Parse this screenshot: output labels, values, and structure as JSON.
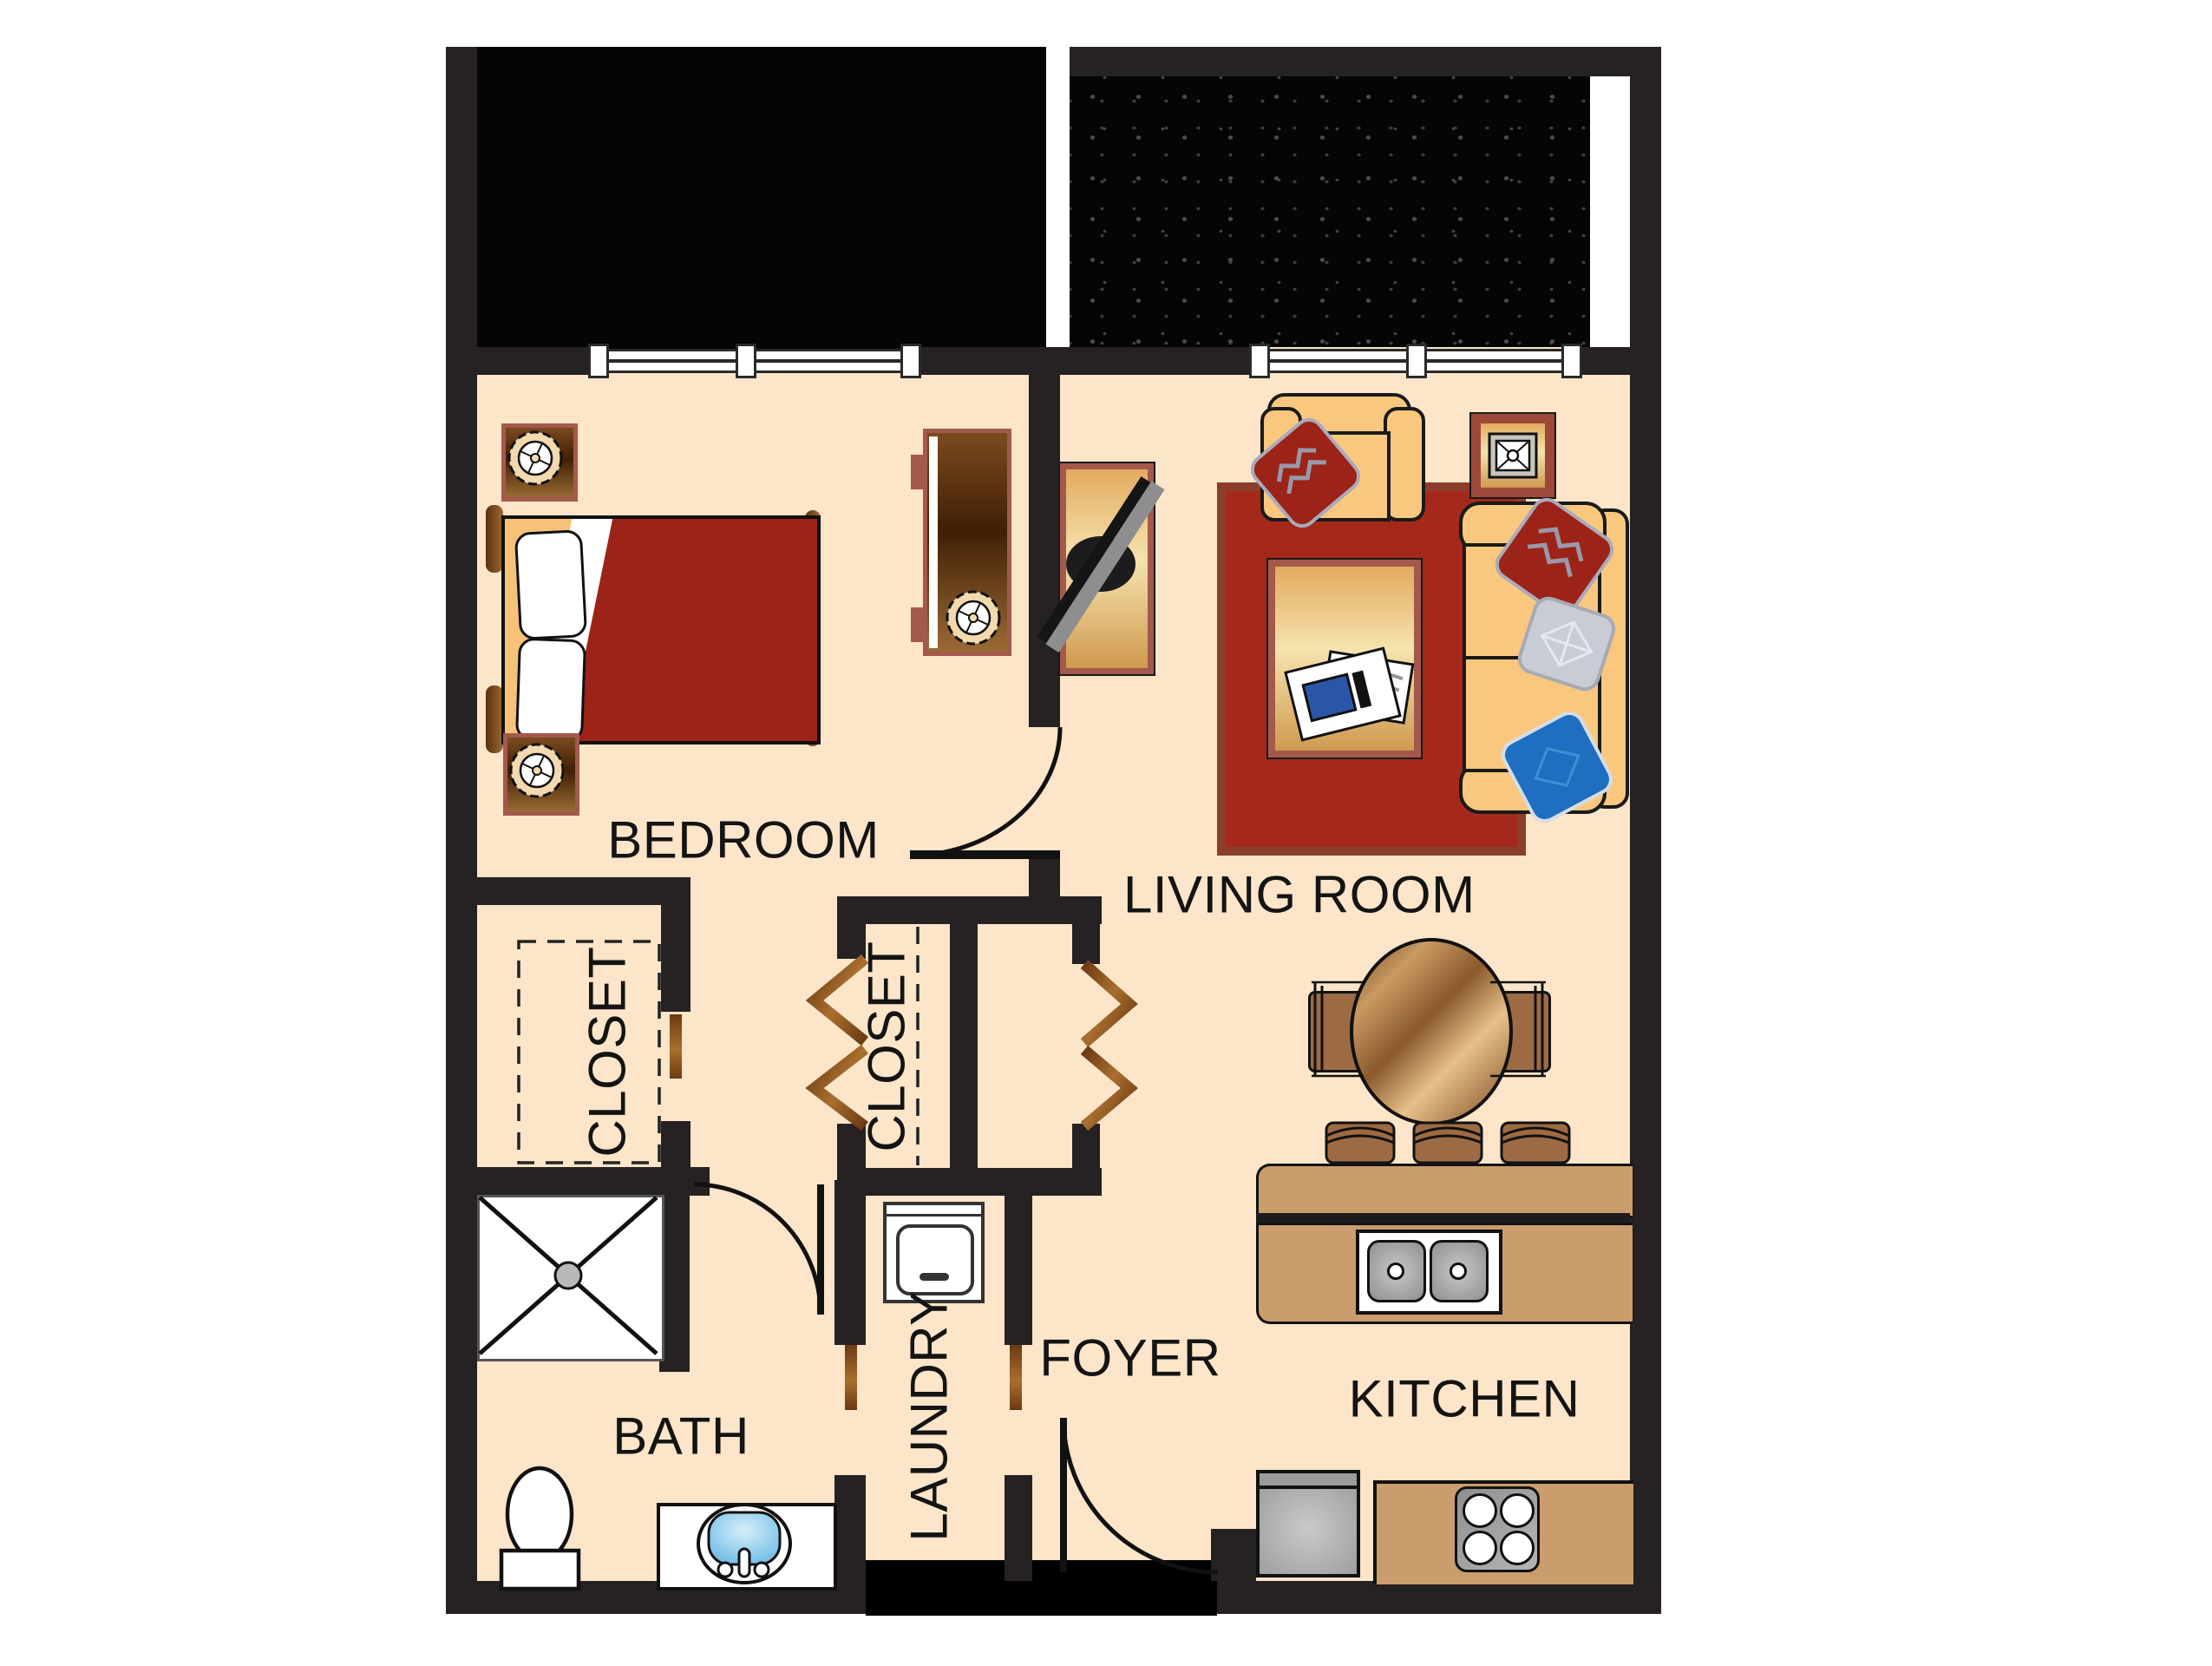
{
  "rooms": {
    "bedroom": "BEDROOM",
    "living_room": "LIVING ROOM",
    "closet_bedroom": "CLOSET",
    "closet_hall": "CLOSET",
    "bath": "BATH",
    "laundry": "LAUNDRY",
    "foyer": "FOYER",
    "kitchen": "KITCHEN"
  },
  "colors": {
    "wall": "#262122",
    "floor": "#fce5c8",
    "balcony": "#050505",
    "rug": "#a4291b",
    "rug_border": "#8c3e2c",
    "upholstery": "#f9c87e",
    "counter": "#cb9c6c",
    "stool": "#9c6b44",
    "maroon": "#a3594c",
    "blanket": "#9c2317",
    "gold_light": "#f6e3ae",
    "pillow_blue": "#1e6fc0",
    "pillow_silver": "#c9ccd4",
    "sink_blue": "#7ec3e8"
  }
}
